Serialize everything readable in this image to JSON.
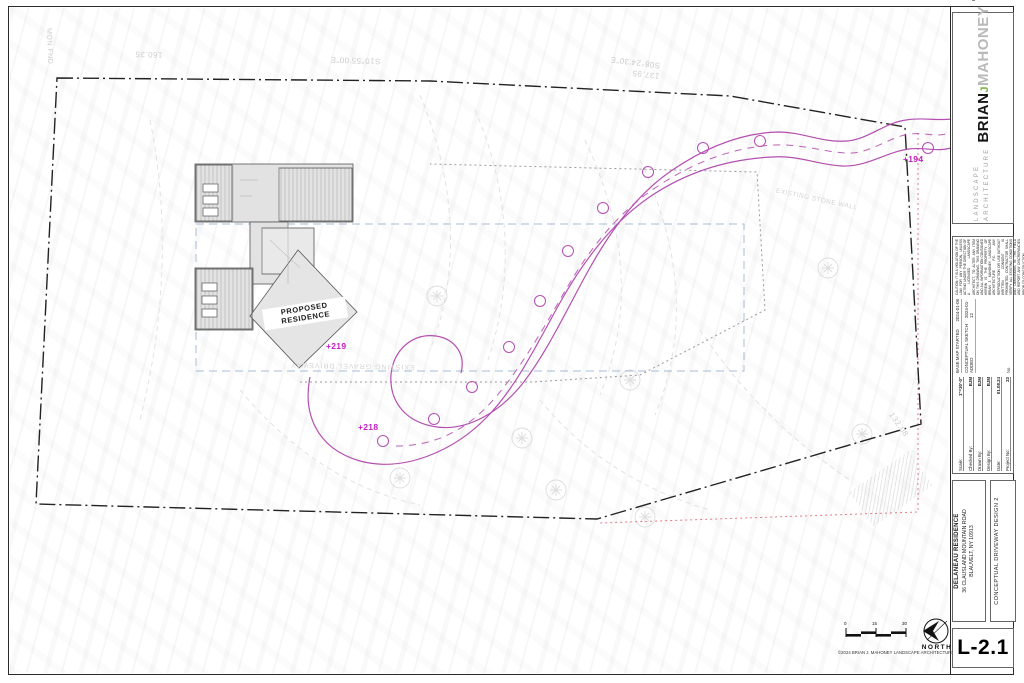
{
  "sheet": {
    "number": "L-2.1",
    "copyright": "©2024 BRIAN J. MAHONEY LANDSCAPE ARCHITECTURE P.C."
  },
  "firm": {
    "name_primary": "BRIAN",
    "name_middle": "J",
    "name_secondary": "MAHONEY",
    "tagline_line1": "LANDSCAPE",
    "tagline_line2": "ARCHITECTURE",
    "contact": [
      "WWW.BRIANMAHONEY.COM",
      "BRIAN@BRIANMAHONEY.COM",
      "40 MORICHES LANE",
      "WESTHAMPTON BEACH, NY 11978",
      "PH: 631.288.0800"
    ]
  },
  "title_block": {
    "disclaimer": "CAUTION: IT IS A VIOLATION OF THE LAW FOR ANY PERSON, UNLESS ACTING UNDER THE DIRECTION OF A LICENSED LANDSCAPE ARCHITECT, TO ALTER ANY ITEM ON THIS DRAWING. THIS DRAWING AND ALL INFORMATION CONTAINED HEREIN IS THE PROPERTY OF BRIAN J. MAHONEY LANDSCAPE ARCHITECTURE P.C. ANY REPRODUCTION OR USE WITHOUT WRITTEN CONSENT IS PROHIBITED. CONTRACTOR SHALL VERIFY ALL EXISTING CONDITIONS AND DIMENSIONS IN THE FIELD AND REPORT ANY DISCREPANCIES PRIOR TO CONSTRUCTION.",
    "fields": [
      {
        "label": "Scale:",
        "value": "1\"=30'-0\""
      },
      {
        "label": "Checked By:",
        "value": "BJM"
      },
      {
        "label": "Drawn By:",
        "value": "BJM"
      },
      {
        "label": "Design By:",
        "value": "BJM"
      },
      {
        "label": "Date:",
        "value": "01.08.24"
      },
      {
        "label": "Project No:",
        "value": "23"
      }
    ],
    "revision_no_header": "No.",
    "revisions": [
      {
        "desc": "BASE MAP STARTED",
        "date": "2024-01-08"
      },
      {
        "desc": "CONCEPTUAL SKETCH ADDED",
        "date": "2024-01-12"
      }
    ],
    "project": {
      "line1": "DELANEAU RESIDENCE",
      "line2": "36 CLAUSLAND MOUNTAIN ROAD",
      "line3": "BLAUVELT, NY 10913"
    },
    "sheet_title": "CONCEPTUAL DRIVEWAY DESIGN 2"
  },
  "plan": {
    "building_label_line1": "PROPOSED",
    "building_label_line2": "RESIDENCE",
    "spot_elevations": [
      {
        "label": "+219"
      },
      {
        "label": "+218"
      },
      {
        "label": "+194"
      }
    ],
    "survey_labels": [
      {
        "text": "160.35"
      },
      {
        "text": "S10°55'00\"E"
      },
      {
        "text": "S08°24'30\"E"
      },
      {
        "text": "137.95"
      },
      {
        "text": "MON FND"
      },
      {
        "text": "132.08"
      },
      {
        "text": "EXISTING GRAVEL DRIVEWAY"
      },
      {
        "text": "EXISTING STONE WALL"
      }
    ],
    "north_label": "NORTH",
    "scale_ticks": [
      "0",
      "15",
      "30"
    ]
  },
  "colors": {
    "driveway": "#b44fb0",
    "spot_elevation": "#c41ec4",
    "boundary": "#222222",
    "setback_line": "#dd6677",
    "limit_line": "#999999",
    "envelope_line": "#8aa7c8",
    "accent_green": "#7ab648"
  }
}
